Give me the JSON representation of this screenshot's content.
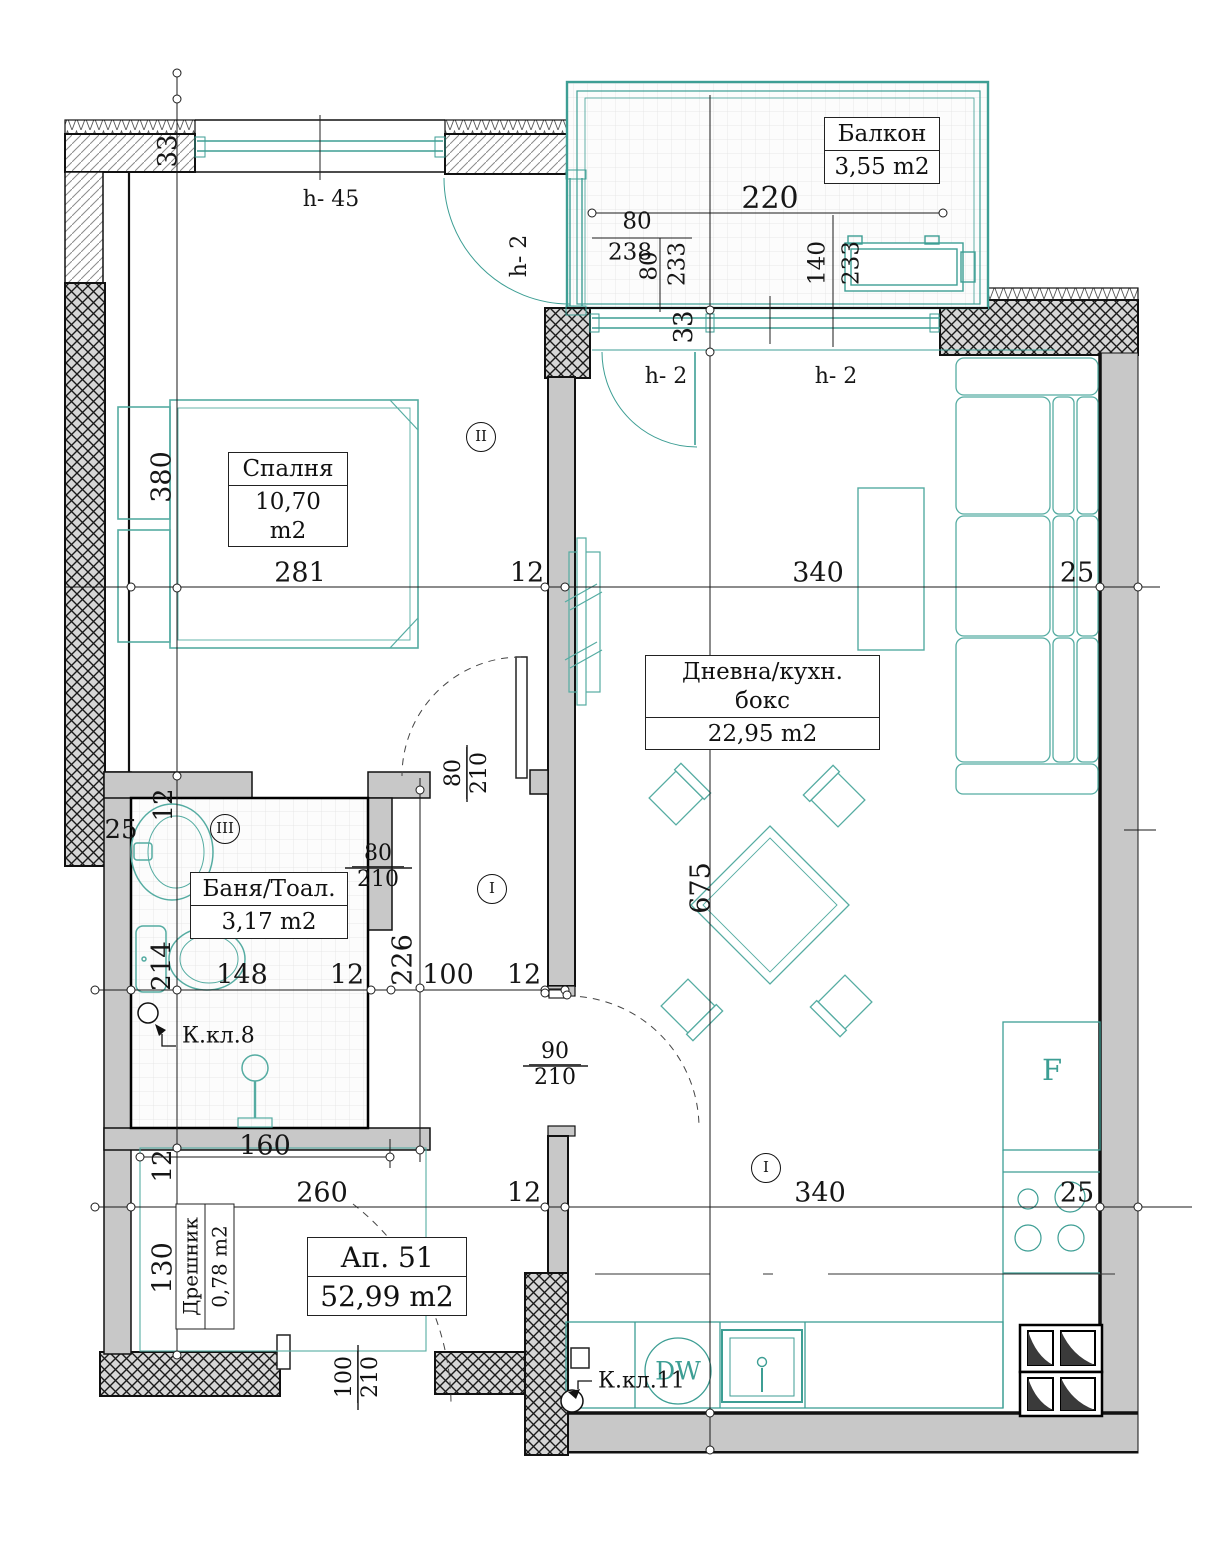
{
  "rooms": {
    "balcony": {
      "name": "Балкон",
      "area": "3,55 m2"
    },
    "bedroom": {
      "name": "Спалня",
      "area": "10,70 m2"
    },
    "living": {
      "name": "Дневна/кухн. бокс",
      "area": "22,95 m2"
    },
    "bathroom": {
      "name": "Баня/Тоал.",
      "area": "3,17 m2"
    },
    "closet": {
      "name": "Дрешник",
      "area": "0,78 m2"
    },
    "apartment": {
      "name": "Ап. 51",
      "area": "52,99 m2"
    }
  },
  "equipment": {
    "dishwasher": "DW",
    "fridge": "F"
  },
  "keys": {
    "k8": "К.кл.8",
    "k11": "К.кл.11"
  },
  "zones": {
    "z1": "II",
    "z2": "III",
    "z3": "I",
    "z4": "I"
  },
  "door_sizes": {
    "bathroom": {
      "w": "80",
      "h": "210"
    },
    "bedroom": {
      "w": "80",
      "h": "210"
    },
    "living": {
      "w": "90",
      "h": "210"
    },
    "entrance": {
      "w": "100",
      "h": "210"
    }
  },
  "colors": {
    "accent_teal": "#3d9e94",
    "wall_gray": "#c8c8c8"
  },
  "annotations": [
    {
      "t": "220",
      "x": 770,
      "y": 199,
      "r": 0,
      "fs": 30
    },
    {
      "t": "80",
      "x": 637,
      "y": 222,
      "r": 0,
      "fs": 23
    },
    {
      "t": "238",
      "x": 630,
      "y": 253,
      "r": 0,
      "fs": 23
    },
    {
      "t": "80",
      "x": 650,
      "y": 266,
      "r": 1,
      "fs": 23
    },
    {
      "t": "233",
      "x": 678,
      "y": 264,
      "r": 1,
      "fs": 23
    },
    {
      "t": "140",
      "x": 818,
      "y": 263,
      "r": 1,
      "fs": 23
    },
    {
      "t": "233",
      "x": 852,
      "y": 263,
      "r": 1,
      "fs": 23
    },
    {
      "t": "33",
      "x": 168,
      "y": 151,
      "r": 1,
      "fs": 26
    },
    {
      "t": "h- 45",
      "x": 331,
      "y": 200,
      "r": 0,
      "fs": 22
    },
    {
      "t": "h- 2",
      "x": 520,
      "y": 256,
      "r": 1,
      "fs": 22
    },
    {
      "t": "33",
      "x": 684,
      "y": 327,
      "r": 1,
      "fs": 26
    },
    {
      "t": "h- 2",
      "x": 666,
      "y": 377,
      "r": 0,
      "fs": 22
    },
    {
      "t": "h- 2",
      "x": 836,
      "y": 377,
      "r": 0,
      "fs": 22
    },
    {
      "t": "380",
      "x": 162,
      "y": 477,
      "r": 1,
      "fs": 27
    },
    {
      "t": "281",
      "x": 300,
      "y": 573,
      "r": 0,
      "fs": 27
    },
    {
      "t": "12",
      "x": 527,
      "y": 573,
      "r": 0,
      "fs": 27
    },
    {
      "t": "340",
      "x": 818,
      "y": 573,
      "r": 0,
      "fs": 27
    },
    {
      "t": "25",
      "x": 1077,
      "y": 573,
      "r": 0,
      "fs": 27
    },
    {
      "t": "675",
      "x": 701,
      "y": 888,
      "r": 1,
      "fs": 27
    },
    {
      "t": "25",
      "x": 121,
      "y": 830,
      "r": 0,
      "fs": 26
    },
    {
      "t": "12",
      "x": 164,
      "y": 805,
      "r": 1,
      "fs": 26
    },
    {
      "t": "214",
      "x": 162,
      "y": 966,
      "r": 1,
      "fs": 26
    },
    {
      "t": "148",
      "x": 242,
      "y": 975,
      "r": 0,
      "fs": 27
    },
    {
      "t": "12",
      "x": 347,
      "y": 975,
      "r": 0,
      "fs": 27
    },
    {
      "t": "226",
      "x": 403,
      "y": 960,
      "r": 1,
      "fs": 27
    },
    {
      "t": "100",
      "x": 448,
      "y": 975,
      "r": 0,
      "fs": 27
    },
    {
      "t": "12",
      "x": 524,
      "y": 975,
      "r": 0,
      "fs": 27
    },
    {
      "t": "160",
      "x": 265,
      "y": 1146,
      "r": 0,
      "fs": 27
    },
    {
      "t": "12",
      "x": 163,
      "y": 1166,
      "r": 1,
      "fs": 26
    },
    {
      "t": "130",
      "x": 163,
      "y": 1268,
      "r": 1,
      "fs": 27
    },
    {
      "t": "260",
      "x": 322,
      "y": 1193,
      "r": 0,
      "fs": 27
    },
    {
      "t": "12",
      "x": 524,
      "y": 1193,
      "r": 0,
      "fs": 27
    },
    {
      "t": "340",
      "x": 820,
      "y": 1193,
      "r": 0,
      "fs": 27
    },
    {
      "t": "25",
      "x": 1077,
      "y": 1193,
      "r": 0,
      "fs": 27
    }
  ]
}
